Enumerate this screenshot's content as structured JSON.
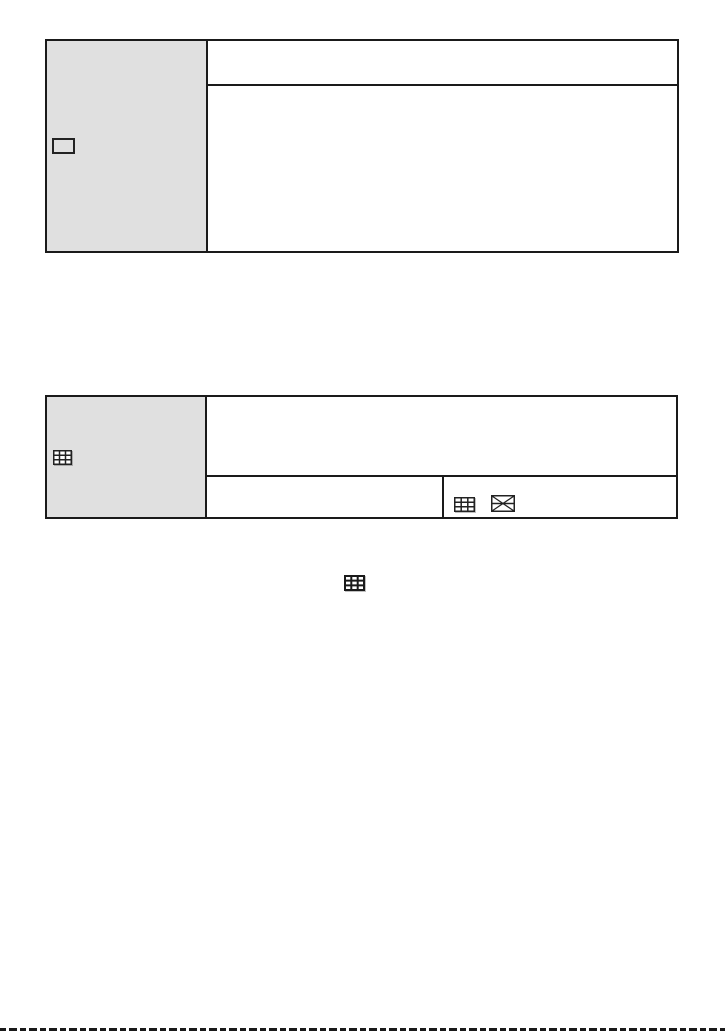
{
  "page": {
    "kind": "manual-page",
    "background": "#ffffff"
  },
  "colors": {
    "line": "#1a1a1a",
    "header_cell_bg": "#e0e0e0",
    "icon_stroke": "#222222"
  },
  "table1": {
    "header_icon": "rectangle-outline-icon",
    "body_rows": 2,
    "row_texts": [
      "",
      ""
    ]
  },
  "table2": {
    "header_icon": "grid-3x3-icon",
    "body_rows": 2,
    "row_texts": [
      "",
      ""
    ],
    "footer_cell_icons": [
      "grid-3x3-icon",
      "diagonal-grid-icon"
    ]
  },
  "inline": {
    "icon": "grid-3x3-bold-icon"
  },
  "footer": {
    "divider_style": "dashed-line"
  }
}
